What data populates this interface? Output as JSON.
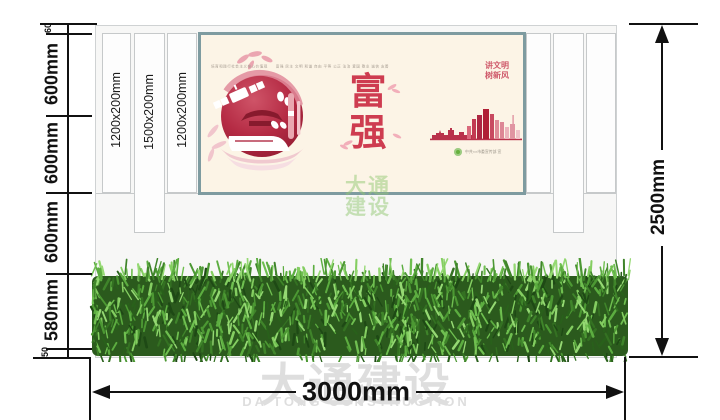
{
  "drawing": {
    "type_label": "宣传栏立面图",
    "total_width": "3000mm",
    "total_height": "2500mm",
    "left_chain": [
      "60",
      "600mm",
      "600mm",
      "600mm",
      "580mm",
      "50"
    ],
    "panel_labels": [
      "1200x200mm",
      "1500x200mm",
      "1200x200mm"
    ]
  },
  "poster": {
    "heading_small": "培育和践行社会主义核心价值观　　富强 民主 文明 和谐 自由 平等 公正 法治 爱国 敬业 诚信 友善",
    "slogan_right_line1": "讲文明",
    "slogan_right_line2": "树新风",
    "main_slogan_char1": "富",
    "main_slogan_char2": "强",
    "publisher": "中共××市委宣传部 宣"
  },
  "watermark": {
    "cn": "大通建设",
    "en": "DA TONG CONSTRUCTION",
    "stamp_row1": "大通",
    "stamp_row2": "建设"
  },
  "colors": {
    "accent_red": "#ce3c50",
    "poster_bg": "#fcf4e6",
    "frame": "#7e9ba0",
    "hedge_green": "#3f842a",
    "dimension": "#111111",
    "watermark_gray": "#d7d7d7",
    "seal_green": "#67b03e"
  }
}
